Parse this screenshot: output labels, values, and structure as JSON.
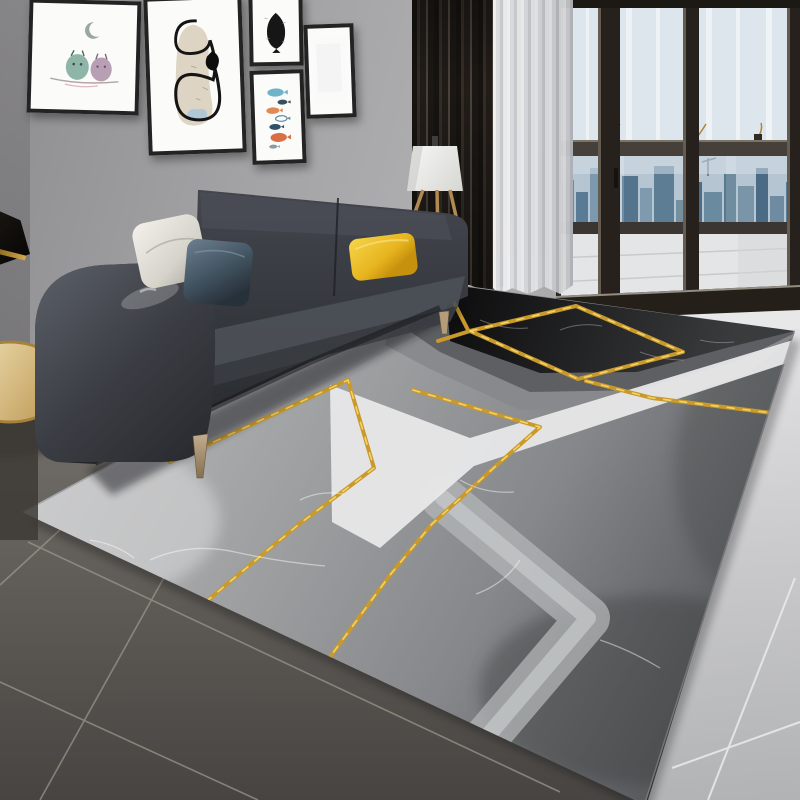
{
  "scene": {
    "type": "photograph",
    "name": "living-room-with-geometric-marble-rug",
    "description": "Modern living room: charcoal fabric sofa with white, blue-grey and mustard-yellow cushions, five framed art prints on a grey wall, white tripod floor lamp, dark brown and sheer white curtains beside a black-framed balcony sliding door with a hazy blue city skyline, a round gold side table, and a large grey-black-white geometric marble-pattern area rug with metallic gold veining lying on dark grey floor tiles with light grey tiles at the right."
  },
  "colors": {
    "wall": "#a5a4a6",
    "wallDark": "#605f61",
    "frame": "#232323",
    "mat": "#fbfbfa",
    "artBlack": "#161616",
    "artBeige": "#d9cfbc",
    "artBlue": "#a8c4d8",
    "owlTeal": "#8fb5a8",
    "owlMauve": "#b79fb4",
    "branch": "#b0a5a3",
    "moon": "#9aa7a5",
    "fishBlue": "#6fb3c9",
    "fishNavy": "#2e4f66",
    "fishOrange": "#de8a50",
    "fishRust": "#d96f45",
    "fishSlate": "#37505e",
    "sofaBase": "#34363b",
    "sofaLight": "#4b4f57",
    "sofaDark": "#232528",
    "pillowWhite": "#f1efe9",
    "pillowBlue": "#64788b",
    "pillowBlueDark": "#2c3842",
    "pillowYellow": "#f5d243",
    "pillowYellowDark": "#d19d12",
    "wood": "#b49c79",
    "woodDark": "#6b5638",
    "lampWood": "#b08a52",
    "shade": "#f5f5f3",
    "curtain": "#211c18",
    "curtainHi": "#4a423a",
    "sheer": "#eceded",
    "doorFrame": "#26211d",
    "glassTop": "#dde6ec",
    "transom": "#46403a",
    "cityBase": "#b5c6d2",
    "bldg1": "#6f8ba1",
    "bldg2": "#5a7b95",
    "bldg3": "#7d99ad",
    "bldg4": "#4e6d88",
    "balconyFloor": "#e3e5e7",
    "threshold": "#242019",
    "doorStrip": "#e8e8e9",
    "floorDark": "#6e6a65",
    "floorDark2": "#474441",
    "grout": "#9b958c",
    "floorLight": "#dfdfe1",
    "floorLight2": "#b5b6b8",
    "groutLight": "#e8e9ea",
    "rugLight": "#b6b7b9",
    "rugMid": "#87898c",
    "rugDark": "#5d5f62",
    "rugBlack": "#121213",
    "rugWhite": "#e9e9ea",
    "rugChevron": "#b3b5b7",
    "gold": "#c9992b",
    "goldHi": "#f2d468",
    "tableTop": "#ecdcae",
    "tableRim": "#a5823b"
  },
  "objects": {
    "gallery_wall": {
      "label": "gallery wall",
      "prints": [
        {
          "name": "owl-print",
          "motif": "two owls on a branch under a crescent moon"
        },
        {
          "name": "abstract-line-print",
          "motif": "black looping line over a beige wash"
        },
        {
          "name": "fish-silhouette-print",
          "motif": "black fish silhouette"
        },
        {
          "name": "fish-school-print",
          "motif": "column of small colourful fish"
        },
        {
          "name": "blank-print",
          "motif": "empty white canvas"
        }
      ]
    },
    "sofa": {
      "label": "charcoal fabric sofa",
      "cushions": [
        "white",
        "blue-grey",
        "mustard-yellow"
      ],
      "legs": "tapered wood"
    },
    "floor_lamp": {
      "label": "tripod floor lamp",
      "shade": "white drum shade"
    },
    "side_table": {
      "label": "round gold side table"
    },
    "curtains": {
      "dark": "floor-length dark brown curtain",
      "sheer": "white voile curtain"
    },
    "balcony_door": {
      "label": "black aluminium sliding door",
      "view": "city skyline through balcony windows"
    },
    "rug": {
      "label": "geometric marble-pattern area rug",
      "pattern": [
        "grey marble field",
        "black marble block",
        "white chevron band",
        "nested grey chevrons",
        "metallic gold veins"
      ]
    },
    "floor": {
      "label": "dark grey tile floor",
      "right_side": "light grey tiles"
    }
  }
}
